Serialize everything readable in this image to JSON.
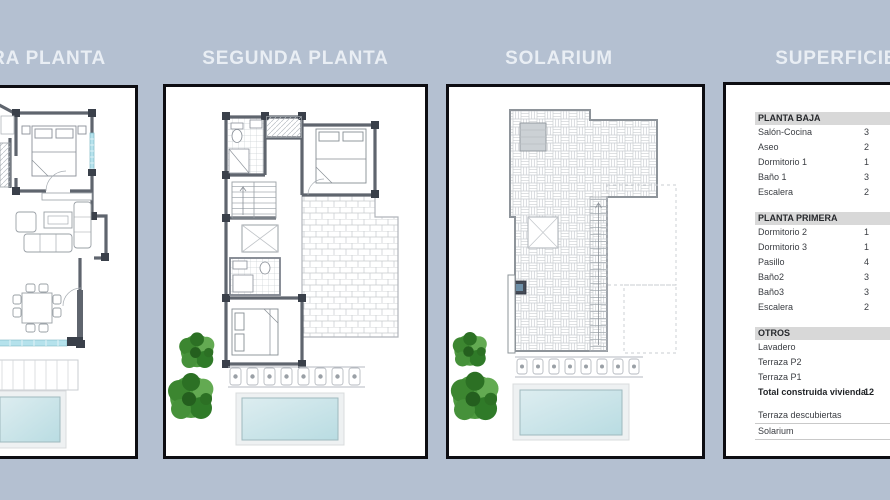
{
  "colors": {
    "background": "#b4c0d1",
    "panel_background": "#ffffff",
    "panel_border": "#0d0d12",
    "title_text": "#e9eef4",
    "table_band": "#d8d8d8",
    "wall_gray": "#5f656e",
    "pool_water": "#bedee4",
    "tree_green": "#3c8630"
  },
  "panels": [
    {
      "title": "PRIMERA PLANTA"
    },
    {
      "title": "SEGUNDA PLANTA"
    },
    {
      "title": "SOLARIUM"
    },
    {
      "title": "SUPERFICIES"
    }
  ],
  "surfaces_table": {
    "sections": [
      {
        "header": "PLANTA BAJA",
        "rows": [
          {
            "label": "Salón-Cocina",
            "value": "3"
          },
          {
            "label": "Aseo",
            "value": "2"
          },
          {
            "label": "Dormitorio 1",
            "value": "1"
          },
          {
            "label": "Baño 1",
            "value": "3"
          },
          {
            "label": "Escalera",
            "value": "2"
          }
        ]
      },
      {
        "header": "PLANTA PRIMERA",
        "rows": [
          {
            "label": "Dormitorio 2",
            "value": "1"
          },
          {
            "label": "Dormitorio 3",
            "value": "1"
          },
          {
            "label": "Pasillo",
            "value": "4"
          },
          {
            "label": "Baño2",
            "value": "3"
          },
          {
            "label": "Baño3",
            "value": "3"
          },
          {
            "label": "Escalera",
            "value": "2"
          }
        ]
      },
      {
        "header": "OTROS",
        "rows": [
          {
            "label": "Lavadero",
            "value": ""
          },
          {
            "label": "Terraza P2",
            "value": ""
          },
          {
            "label": "Terraza P1",
            "value": ""
          },
          {
            "label": "Total construida vivienda",
            "value": "12",
            "bold": true
          }
        ]
      }
    ],
    "footer_rows": [
      {
        "label": "Terraza descubiertas",
        "value": ""
      },
      {
        "label": "Solarium",
        "value": ""
      }
    ]
  }
}
